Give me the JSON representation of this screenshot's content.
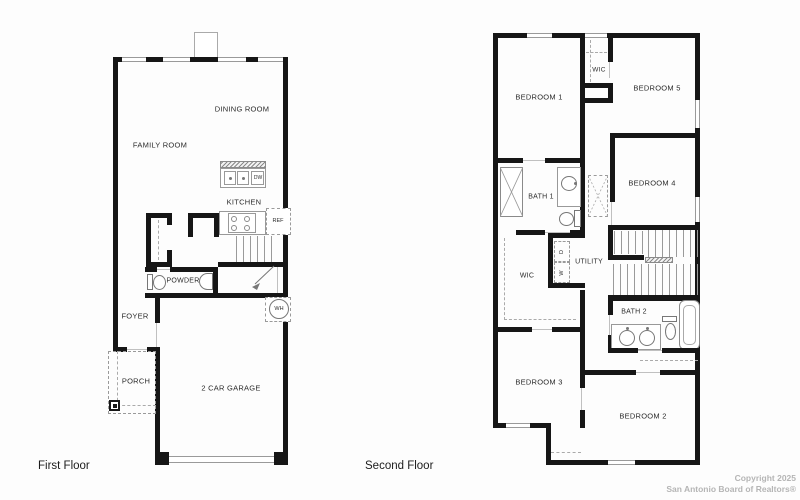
{
  "first_floor": {
    "title": "First Floor",
    "labels": {
      "family_room": "FAMILY ROOM",
      "dining_room": "DINING ROOM",
      "kitchen": "KITCHEN",
      "powder": "POWDER",
      "foyer": "FOYER",
      "porch": "PORCH",
      "garage": "2 CAR GARAGE",
      "dw": "DW",
      "ref": "REF",
      "wh": "WH"
    }
  },
  "second_floor": {
    "title": "Second Floor",
    "labels": {
      "bedroom1": "BEDROOM 1",
      "bedroom2": "BEDROOM 2",
      "bedroom3": "BEDROOM 3",
      "bedroom4": "BEDROOM 4",
      "bedroom5": "BEDROOM 5",
      "wic_upper": "WIC",
      "wic_mid": "WIC",
      "bath1": "BATH 1",
      "bath2": "BATH 2",
      "utility": "UTILITY",
      "washer": "W",
      "dryer": "D"
    }
  },
  "footer": {
    "copyright_line1": "Copyright 2025",
    "copyright_line2": "San Antonio Board of Realtors®"
  },
  "colors": {
    "wall": "#161616",
    "thin_line": "#9a9a9a",
    "label_text": "#2b2b2b",
    "copyright_text": "#b5b5b5",
    "background": "#fdfdfd"
  }
}
